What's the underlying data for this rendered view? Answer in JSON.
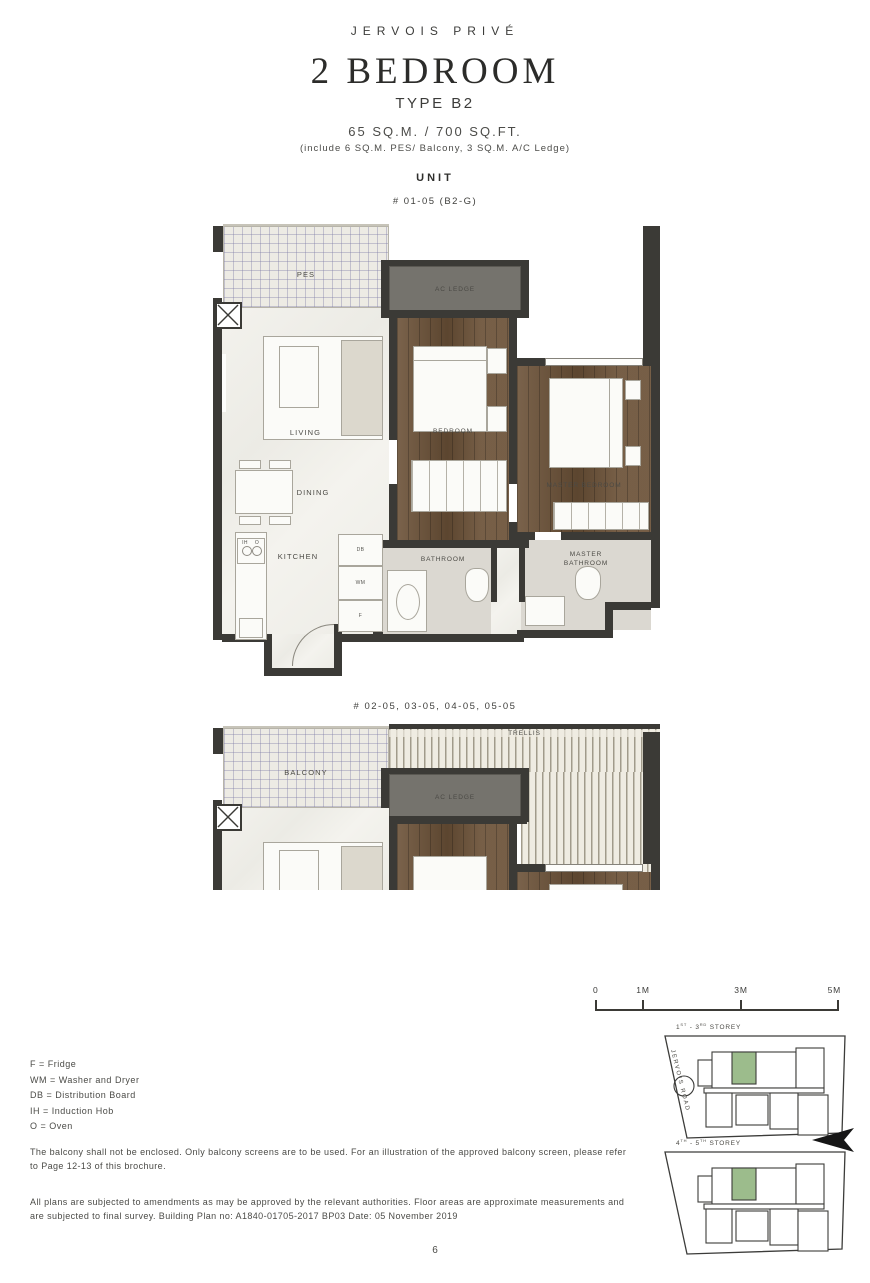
{
  "header": {
    "brand": "JERVOIS PRIVÉ",
    "title": "2 BEDROOM",
    "subtitle": "TYPE B2",
    "area": "65 SQ.M. / 700 SQ.FT.",
    "area_note": "(include 6 SQ.M. PES/ Balcony, 3 SQ.M. A/C Ledge)",
    "unit_label": "UNIT"
  },
  "plan1": {
    "unit_no": "# 01-05 (B2-G)",
    "rooms": {
      "pes": "PES",
      "ac_ledge": "AC LEDGE",
      "living": "LIVING",
      "dining": "DINING",
      "kitchen": "KITCHEN",
      "bedroom": "BEDROOM",
      "master_bedroom": "MASTER BEDROOM",
      "bathroom": "BATHROOM",
      "master_bathroom": "MASTER BATHROOM"
    },
    "appliances": {
      "db": "DB",
      "wm": "WM",
      "f": "F",
      "ih": "IH",
      "o": "O"
    }
  },
  "plan2": {
    "unit_no": "# 02-05, 03-05, 04-05, 05-05",
    "rooms": {
      "trellis": "TRELLIS",
      "balcony": "BALCONY",
      "ac_ledge": "AC LEDGE"
    }
  },
  "scalebar": {
    "labels": [
      "0",
      "1M",
      "3M",
      "5M"
    ]
  },
  "siteplans": {
    "road_label": "JERVOIS ROAD",
    "plan_a": {
      "p1": "1",
      "s1": "ST",
      "p2": " - 3",
      "s2": "RD",
      "p3": " STOREY"
    },
    "plan_b": {
      "p1": "4",
      "s1": "TH",
      "p2": " - 5",
      "s2": "TH",
      "p3": " STOREY"
    }
  },
  "legend": {
    "items": [
      "F = Fridge",
      "WM = Washer and Dryer",
      "DB = Distribution Board",
      "IH = Induction Hob",
      "O = Oven"
    ]
  },
  "notes": {
    "balcony": "The balcony shall not be enclosed. Only balcony screens are to be used. For an illustration of the approved balcony screen, please refer to Page 12-13 of this brochure.",
    "disclaimer": "All plans are subjected to amendments as may be approved by the relevant authorities. Floor areas are approximate measurements and are subjected to final survey. Building Plan no: A1840-01705-2017 BP03 Date: 05 November 2019"
  },
  "page_number": "6",
  "colors": {
    "accent_green": "#9CBC8C",
    "wall": "#3B3A36",
    "wood": "#6B5137"
  }
}
